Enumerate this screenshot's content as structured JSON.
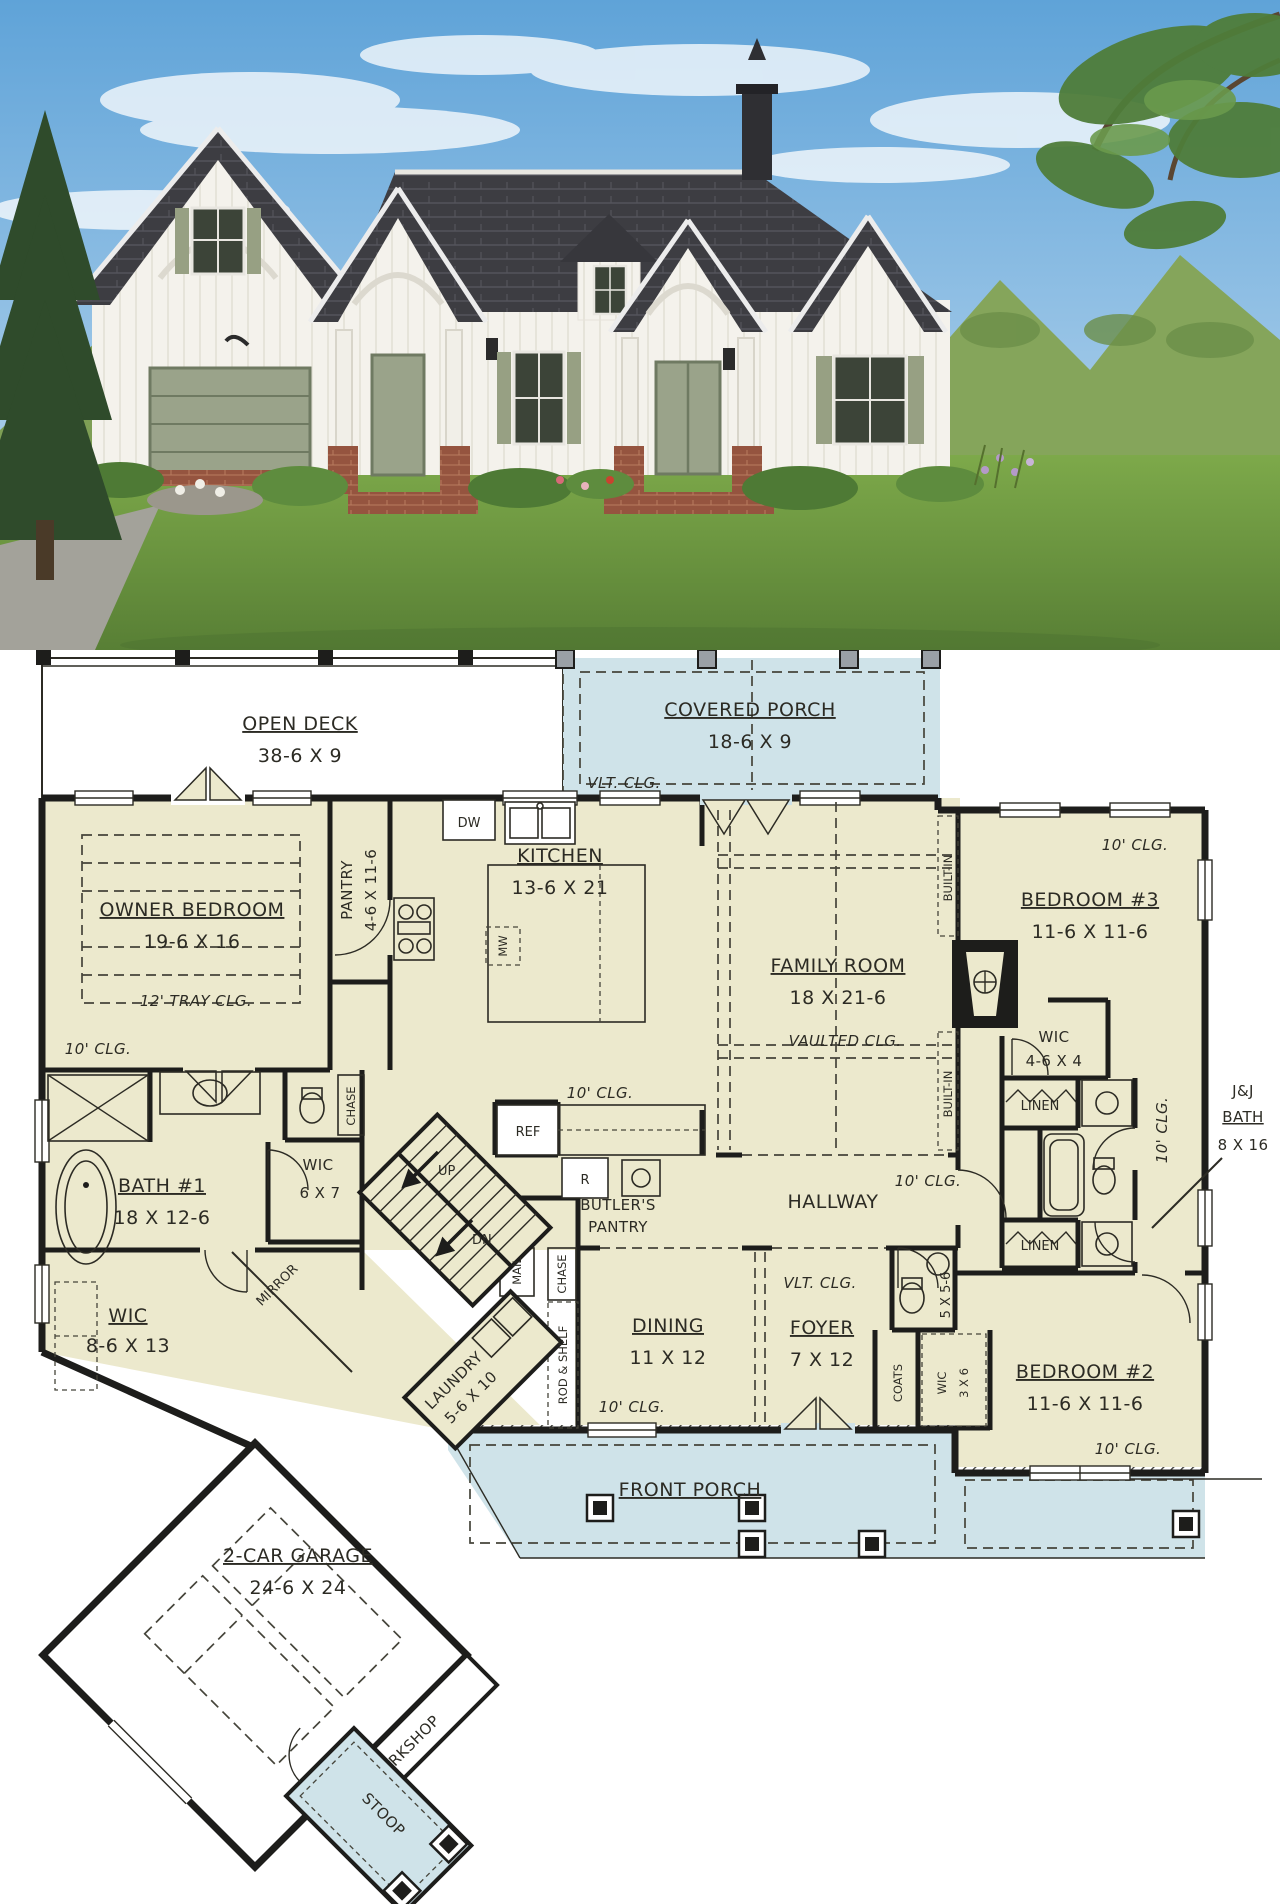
{
  "colors": {
    "plan_room": "#ece9cd",
    "porch": "#cfe3e9",
    "wall": "#1d1d1b",
    "sky": "#6aabdd",
    "roof": "#3d3d42",
    "siding": "#f4f2ec",
    "shutter": "#97a083",
    "brick": "#95543f",
    "lawn": "#6f9a40"
  },
  "plan": {
    "open_deck": {
      "name": "OPEN DECK",
      "dims": "38-6 X 9"
    },
    "covered_porch": {
      "name": "COVERED PORCH",
      "dims": "18-6 X 9",
      "clg": "VLT. CLG."
    },
    "owner_bedroom": {
      "name": "OWNER BEDROOM",
      "dims": "19-6 X 16",
      "tray": "12' TRAY CLG.",
      "clg": "10' CLG."
    },
    "pantry": {
      "name": "PANTRY",
      "dims": "4-6 X 11-6"
    },
    "kitchen": {
      "name": "KITCHEN",
      "dims": "13-6 X 21",
      "clg": "10' CLG."
    },
    "family_room": {
      "name": "FAMILY ROOM",
      "dims": "18 X 21-6",
      "clg": "VAULTED CLG."
    },
    "built_in": "BUILT-IN",
    "bedroom3": {
      "name": "BEDROOM #3",
      "dims": "11-6 X 11-6",
      "clg": "10' CLG."
    },
    "wic_bed3": {
      "name": "WIC",
      "dims": "4-6 X 4"
    },
    "linen": "LINEN",
    "suite_clg": "10' CLG.",
    "jj_bath": {
      "l1": "J&J",
      "l2": "BATH",
      "dims": "8 X 16"
    },
    "bath1": {
      "name": "BATH #1",
      "dims": "18 X 12-6"
    },
    "wic_bath1": {
      "name": "WIC",
      "dims": "6 X 7"
    },
    "chase": "CHASE",
    "mirror": "MIRROR",
    "stairs": {
      "up": "UP",
      "dn": "DN"
    },
    "owner_wic": {
      "name": "WIC",
      "dims": "8-6 X 13"
    },
    "hallway": {
      "name": "HALLWAY",
      "clg": "10' CLG."
    },
    "butlers": {
      "l1": "BUTLER'S",
      "l2": "PANTRY"
    },
    "mail": "MAIL",
    "rod_shelf": "ROD & SHELF",
    "laundry": {
      "name": "LAUNDRY",
      "dims": "5-6 X 10"
    },
    "dining": {
      "name": "DINING",
      "dims": "11 X 12",
      "clg": "10' CLG."
    },
    "foyer": {
      "name": "FOYER",
      "dims": "7 X 12",
      "clg": "VLT. CLG."
    },
    "coats": "COATS",
    "wic_bed2": {
      "name": "WIC",
      "dims": "3 X 6"
    },
    "powder_dims": "5 X 5-6",
    "bedroom2": {
      "name": "BEDROOM #2",
      "dims": "11-6 X 11-6",
      "clg": "10' CLG."
    },
    "front_porch": "FRONT PORCH",
    "garage": {
      "name": "2-CAR GARAGE",
      "dims": "24-6 X 24"
    },
    "workshop": "WORKSHOP",
    "stoop": "STOOP",
    "appliances": {
      "dw": "DW",
      "mw": "MW",
      "ref": "REF",
      "range": "R"
    }
  }
}
